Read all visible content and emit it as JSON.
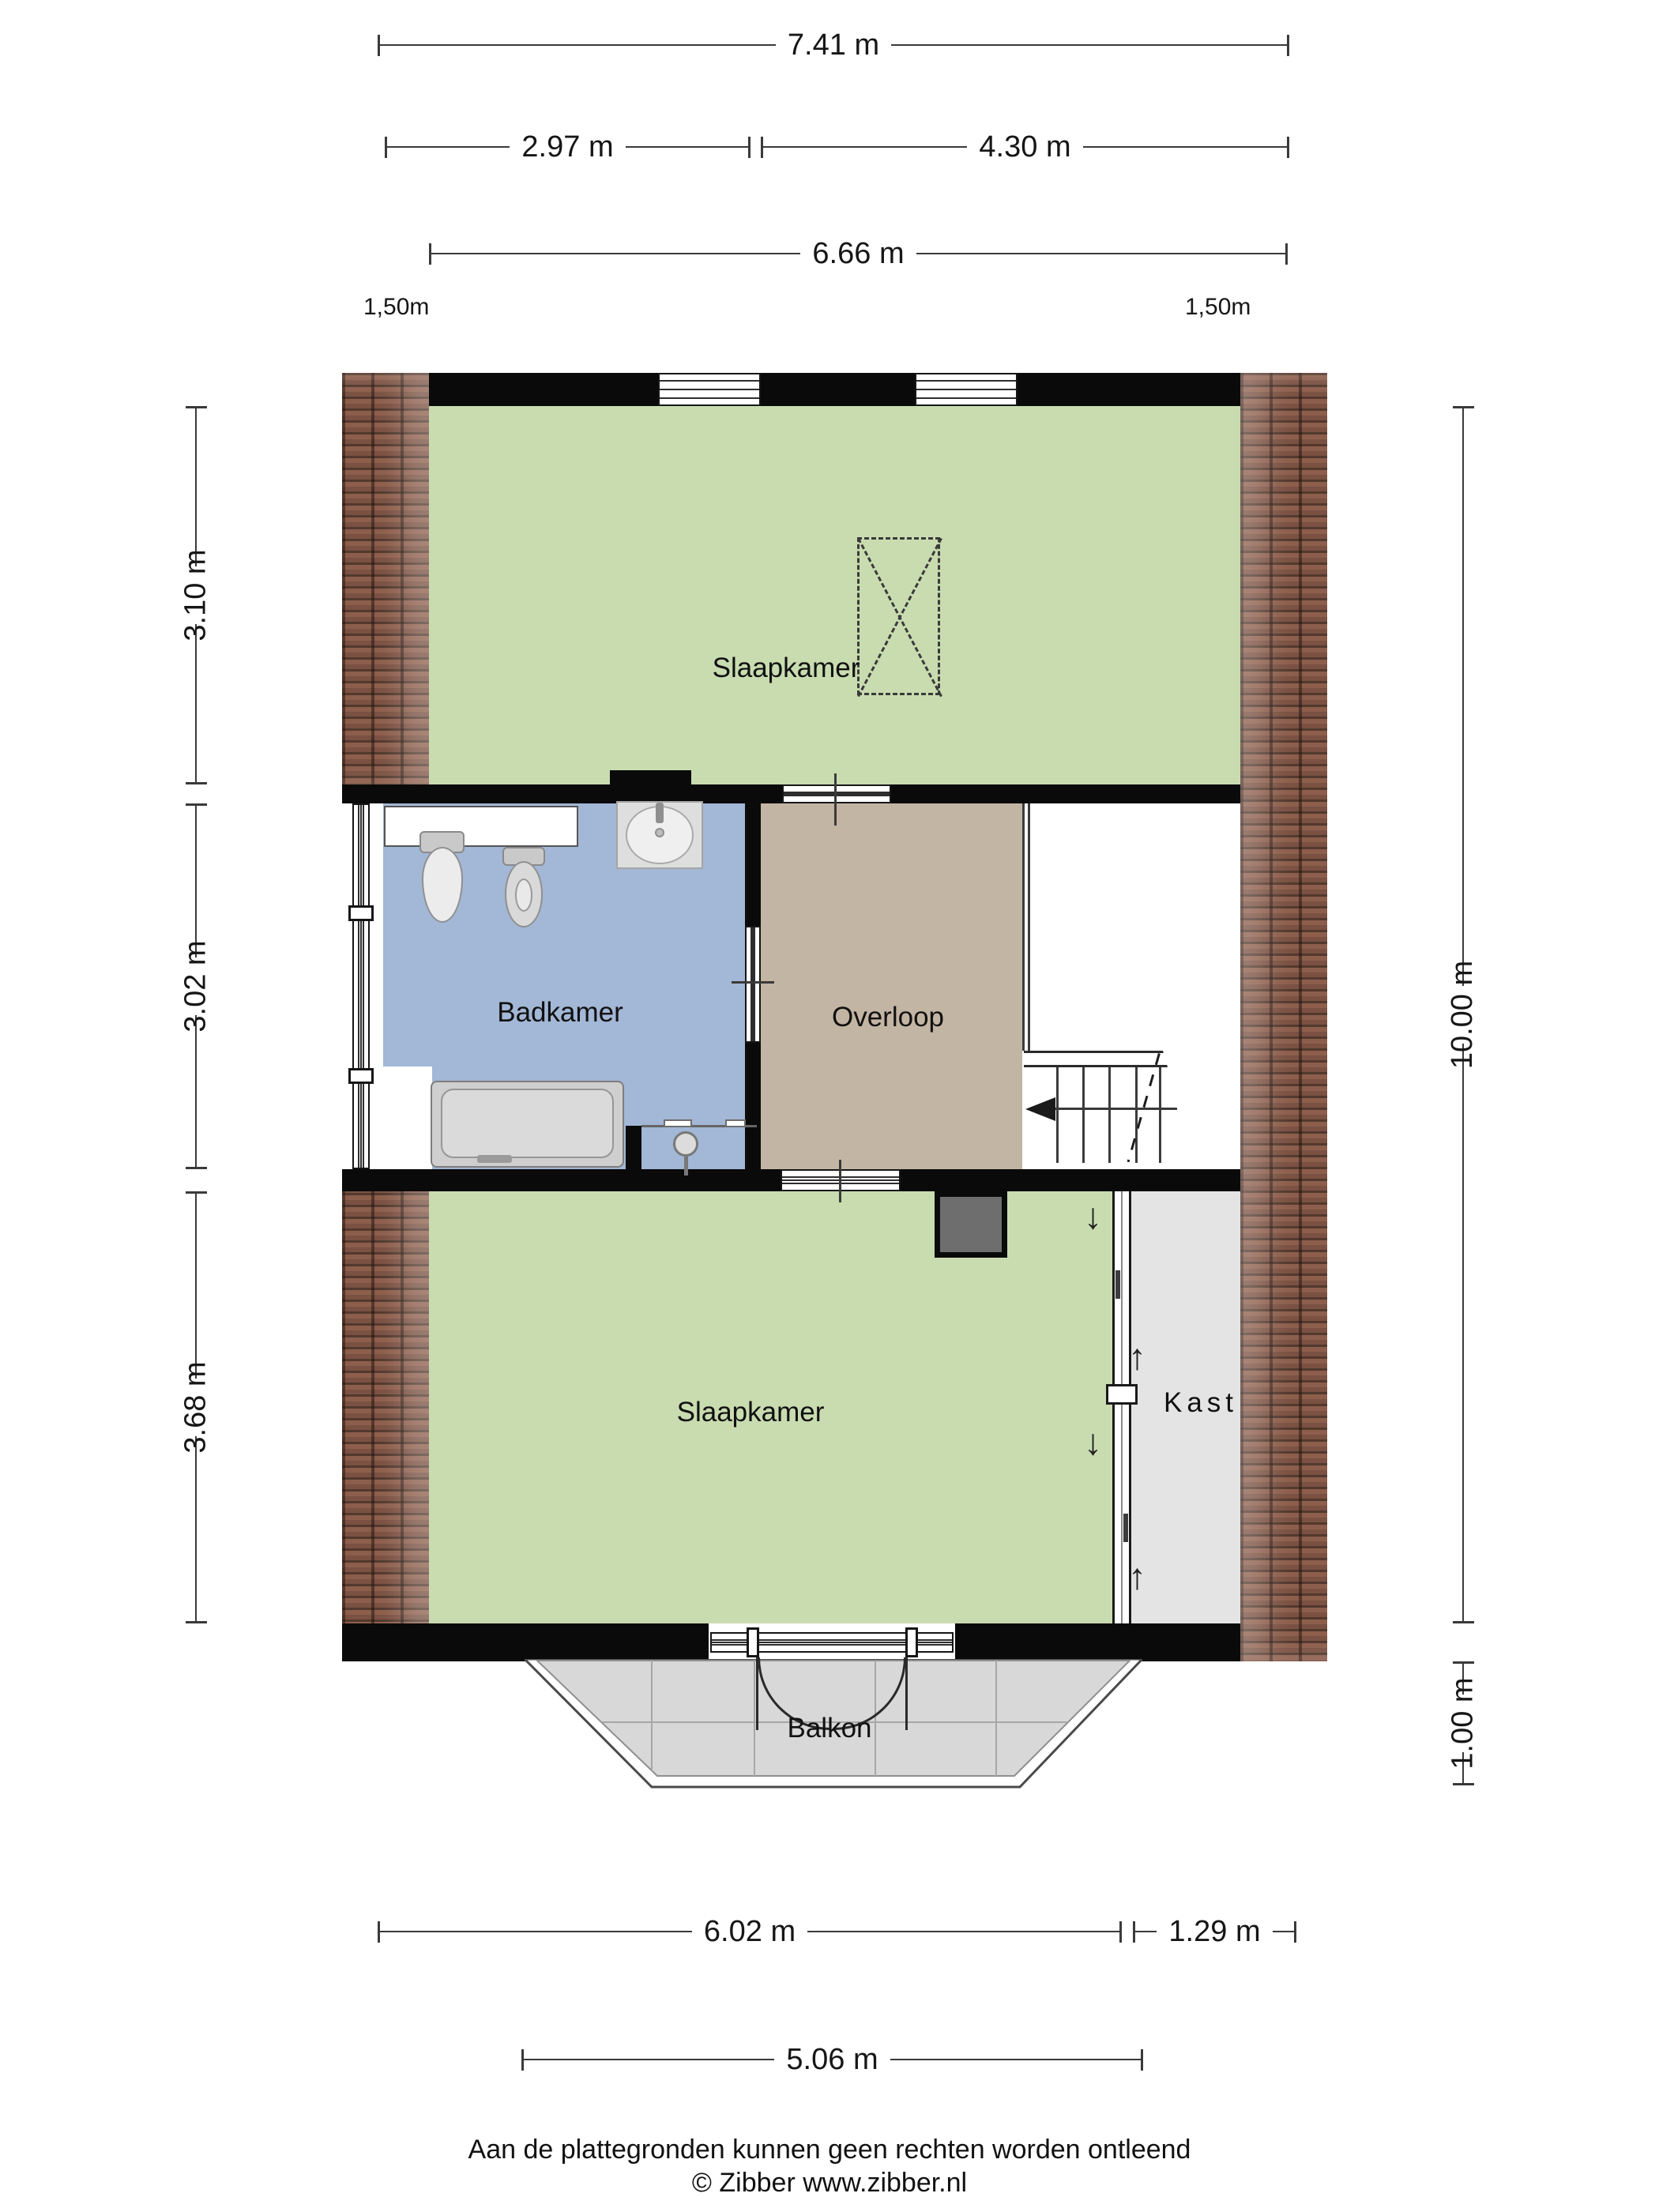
{
  "plan": {
    "type": "floor-plan",
    "floor": "verdieping (upper floor)",
    "units": "m"
  },
  "dims": {
    "w741": {
      "label": "7.41 m"
    },
    "w297": {
      "label": "2.97 m"
    },
    "w430": {
      "label": "4.30 m"
    },
    "w666": {
      "label": "6.66 m"
    },
    "knee_left": {
      "label": "1,50m"
    },
    "knee_right": {
      "label": "1,50m"
    },
    "h310": {
      "label": "3.10 m"
    },
    "h302": {
      "label": "3.02 m"
    },
    "h368": {
      "label": "3.68 m"
    },
    "h1000": {
      "label": "10.00 m"
    },
    "h100": {
      "label": "1.00 m"
    },
    "w602": {
      "label": "6.02 m"
    },
    "w129": {
      "label": "1.29 m"
    },
    "w506": {
      "label": "5.06 m"
    }
  },
  "rooms": {
    "bedroom_top": {
      "label": "Slaapkamer",
      "fill": "#c9dcb0"
    },
    "bathroom": {
      "label": "Badkamer",
      "fill": "#a3b7d6"
    },
    "landing": {
      "label": "Overloop",
      "fill": "#c3b5a3"
    },
    "bedroom_bottom": {
      "label": "Slaapkamer",
      "fill": "#c9dcb0"
    },
    "closet": {
      "label": "Kast",
      "fill": "#e4e4e4"
    },
    "balcony": {
      "label": "Balkon",
      "fill": "#d8d8d8"
    }
  },
  "icons": {
    "arrow_up": "↑",
    "arrow_down": "↓"
  },
  "colors": {
    "wall": "#0a0a0a",
    "brick": "#8a5a49",
    "dimension_line": "#3a3a3a",
    "chimney": "#6e6e6e",
    "stair_white": "#ffffff"
  },
  "footer": {
    "disclaimer": "Aan de plattegronden kunnen geen rechten worden ontleend",
    "copyright": "© Zibber www.zibber.nl"
  }
}
